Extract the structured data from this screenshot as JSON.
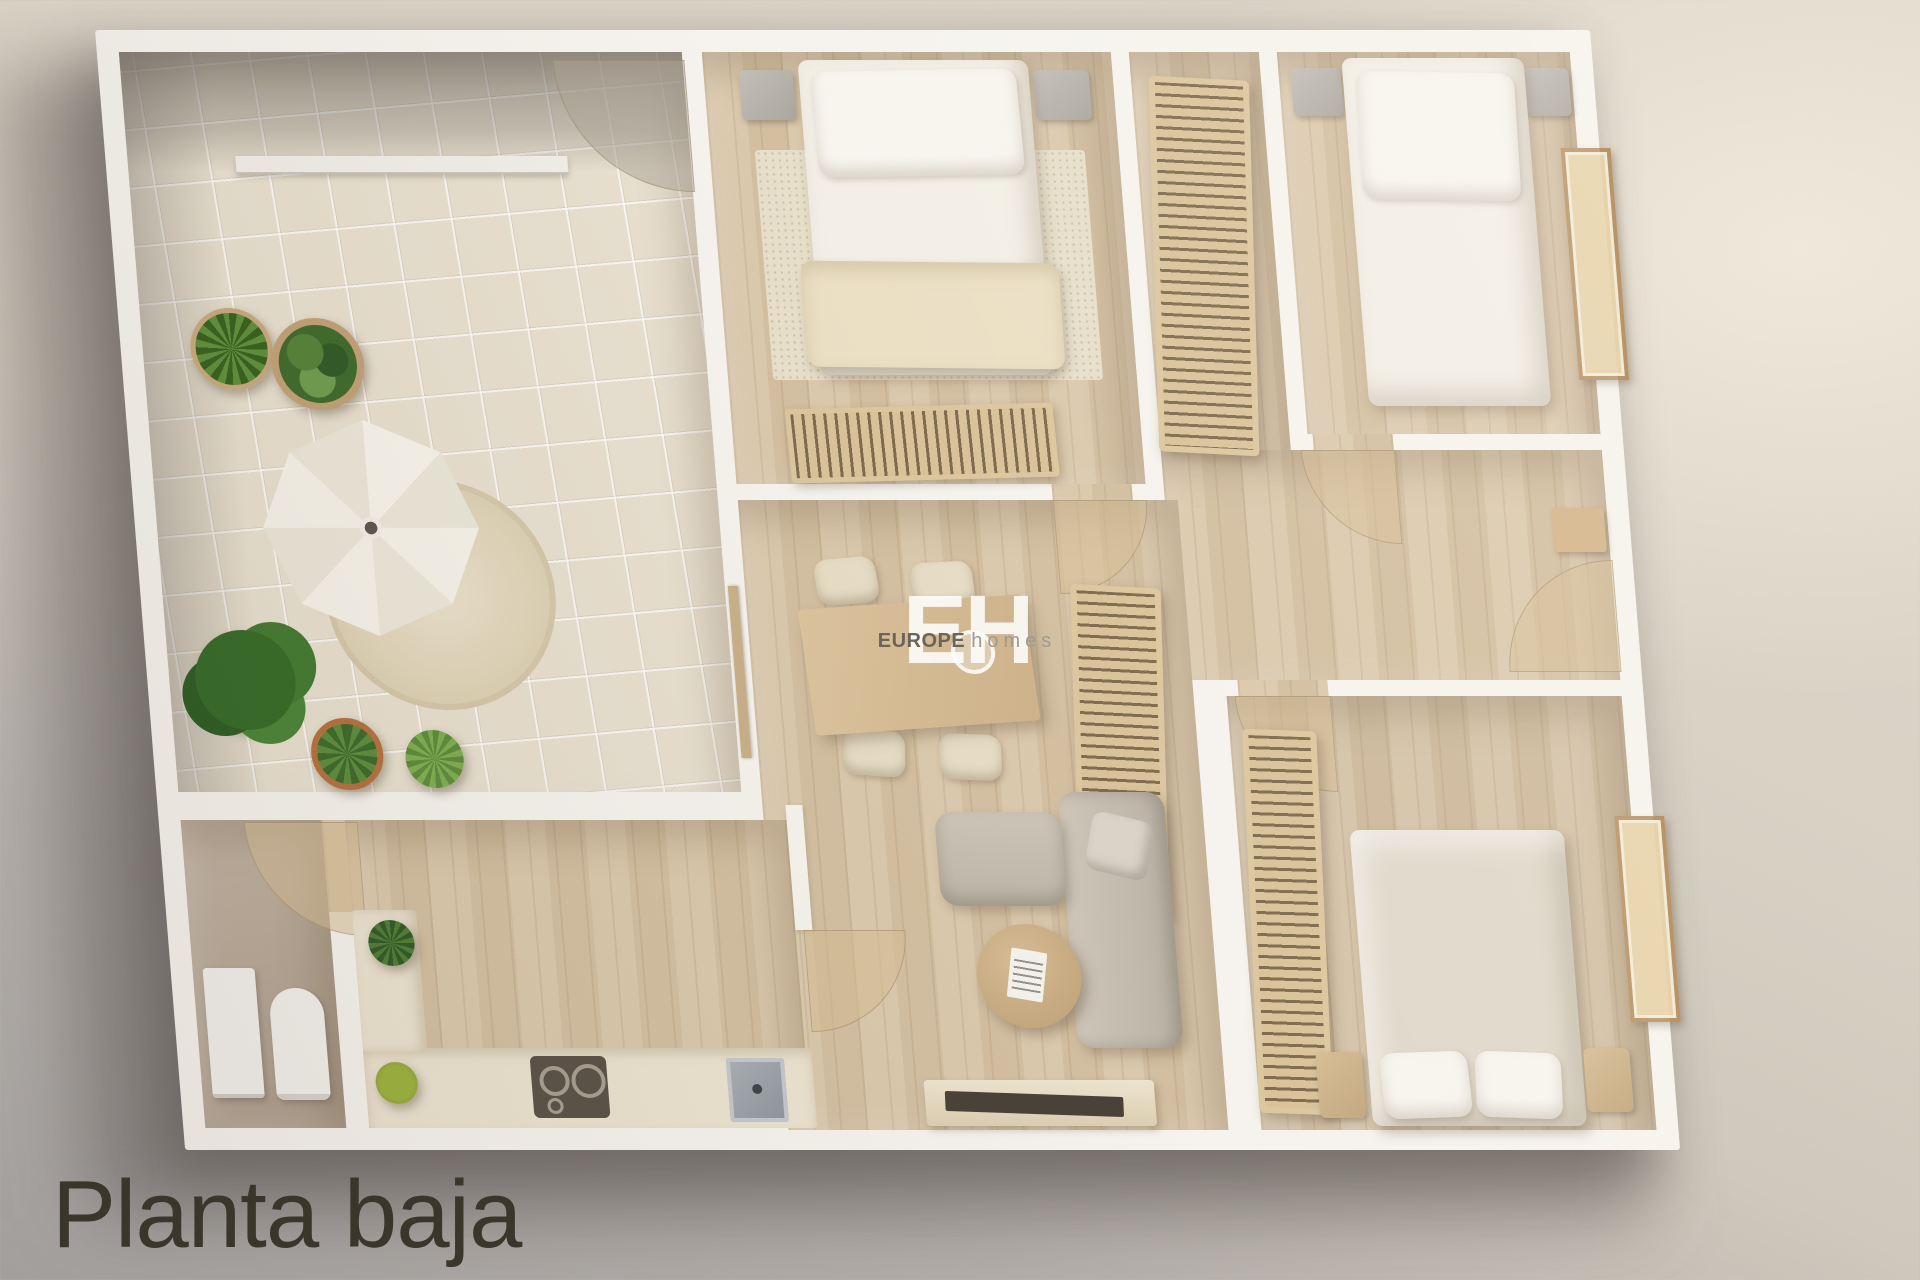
{
  "title": {
    "label": "Planta baja"
  },
  "watermark": {
    "monogram": "EH",
    "word_primary": "EUROPE",
    "word_secondary": "homes",
    "monogram_color": "rgba(255,255,255,0.85)",
    "primary_color": "#6c6359",
    "secondary_color": "#a09a8f"
  },
  "palette": {
    "background_top": "#ded6c9",
    "background_bottom": "#a29f9d",
    "walls": "#f6f3ee",
    "wood_floor": "#d9c6a8",
    "terrace_tile": "#e8e0d0",
    "bathroom_floor": "#b7a898",
    "sofa": "#c5beb1",
    "kitchen_counter": "#ece3d1",
    "bedding_white": "#f3efe6",
    "blanket_cream": "#ebdfc4",
    "duvet_bed3": "#e0d8ca",
    "slat_wood": "#d9c299",
    "plant_green": "#4c7a33",
    "title_text": "#3b362b"
  },
  "floorplan": {
    "rooms": [
      "terrace",
      "bedroom-1",
      "wardrobe-niche",
      "bedroom-2",
      "hall",
      "living-dining",
      "kitchen",
      "bathroom",
      "bedroom-3"
    ],
    "objects": [
      "parasol",
      "round-outdoor-rug",
      "potted-plants",
      "double-bed",
      "bed-pillows",
      "nightstands",
      "slatted-bench",
      "louvered-wardrobe",
      "dining-table",
      "dining-chairs",
      "drinking-glass",
      "louvered-sideboard",
      "l-shaped-sofa",
      "sofa-cushion",
      "coffee-table",
      "magazine",
      "tv-console",
      "tv",
      "kitchen-counter",
      "cooktop",
      "kitchen-sink",
      "bathroom-sink",
      "toilet",
      "door-swing-arcs",
      "windows",
      "sliding-door"
    ]
  }
}
